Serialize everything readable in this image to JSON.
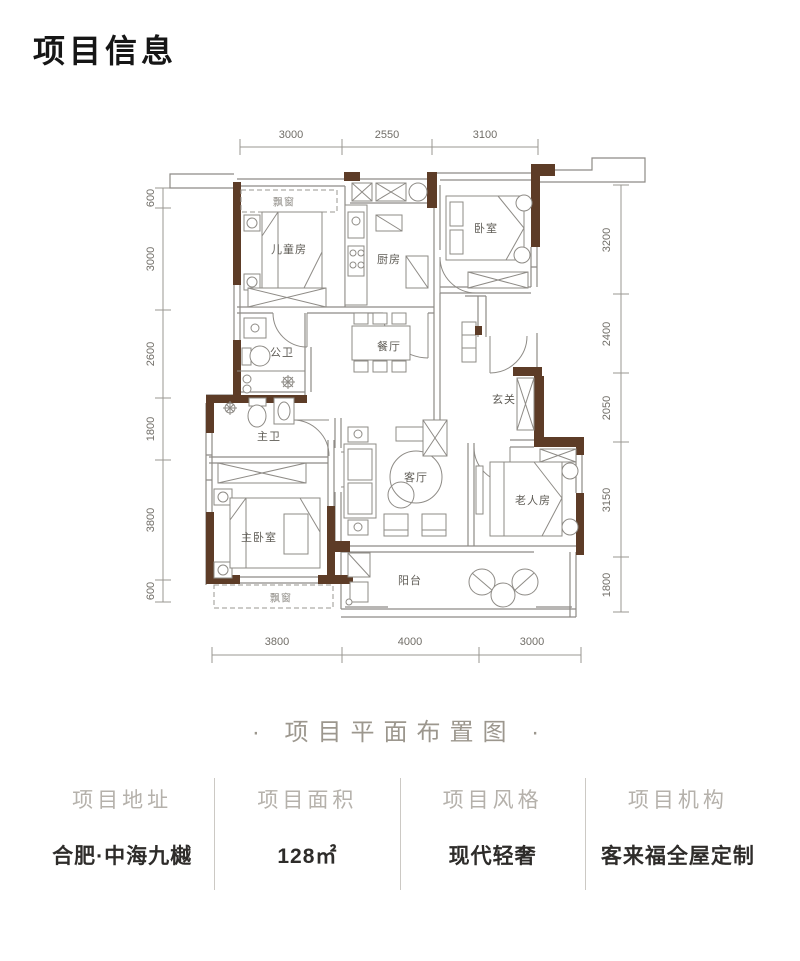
{
  "page": {
    "title": "项目信息",
    "caption": "· 项目平面布置图 ·"
  },
  "floorplan": {
    "rooms": [
      "飘窗",
      "儿童房",
      "厨房",
      "卧室",
      "公卫",
      "餐厅",
      "玄关",
      "主卫",
      "客厅",
      "主卧室",
      "老人房",
      "阳台",
      "飘窗"
    ],
    "dims_top": [
      "3000",
      "2550",
      "3100"
    ],
    "dims_bottom": [
      "3800",
      "4000",
      "3000"
    ],
    "dims_left": [
      "600",
      "3000",
      "2600",
      "1800",
      "3800",
      "600"
    ],
    "dims_right": [
      "3200",
      "2400",
      "2050",
      "3150",
      "1800"
    ]
  },
  "info": {
    "items": [
      {
        "label": "项目地址",
        "value": "合肥·中海九樾"
      },
      {
        "label": "项目面积",
        "value": "128㎡"
      },
      {
        "label": "项目风格",
        "value": "现代轻奢"
      },
      {
        "label": "项目机构",
        "value": "客来福全屋定制"
      }
    ]
  },
  "colors": {
    "wall": "#5d3c27",
    "line": "#8e8b86",
    "dimline": "#9a9792"
  }
}
